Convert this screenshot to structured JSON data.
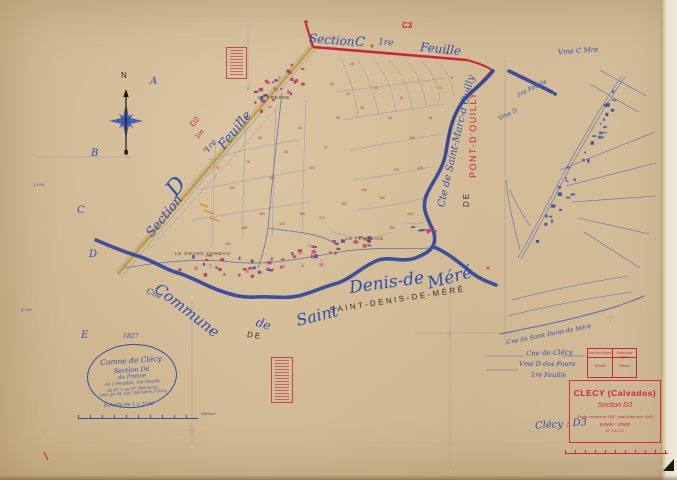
{
  "colors": {
    "paper": "#d5bc94",
    "ink_blue": "#2e4fae",
    "ink_red": "#c5283c",
    "ink_black": "#35302a",
    "boundary_blue": "#2b3f9d",
    "road_ochre": "#bb9733"
  },
  "compass": {
    "n": "N"
  },
  "grid_letters": [
    {
      "t": "A",
      "x": 150,
      "y": 76
    },
    {
      "t": "B",
      "x": 91,
      "y": 148
    },
    {
      "t": "C",
      "x": 77,
      "y": 205
    },
    {
      "t": "D",
      "x": 89,
      "y": 249
    },
    {
      "t": "E",
      "x": 81,
      "y": 330
    }
  ],
  "edge_notes": [
    {
      "t": "3.090",
      "x": 33,
      "y": 182
    },
    {
      "t": "4.581",
      "x": 21,
      "y": 307
    }
  ],
  "top_labels": {
    "section": "Section",
    "c": "C",
    "premiere": "1re",
    "feuille": "Feuille",
    "c3": "C3"
  },
  "west_labels": {
    "section": "Section",
    "d": "D",
    "premiere": "1re",
    "feuille": "Feuille",
    "d2": "D2",
    "d2_sheet": "1re"
  },
  "east_labels": {
    "saint_marc": "Cte de Saint-Marc-d'Ouilly",
    "pont": "PONT-D'OUILLY",
    "de": "DE",
    "vme_d": "Vme D",
    "feuille": "1re Feuille"
  },
  "south_labels": {
    "cne": "Cne",
    "commune": "Commune",
    "de_print": "DE",
    "de_script": "de",
    "saint": "Saint",
    "print": "SAINT-DENIS-DE-MÉRÉ",
    "denis": "Denis-de",
    "mere": "Méré"
  },
  "hamlets": [
    {
      "t": "LE FRESNE",
      "x": 258,
      "y": 95
    },
    {
      "t": "LE GRAND HAMEAU",
      "x": 175,
      "y": 251
    },
    {
      "t": "LE FLAGUAIS",
      "x": 346,
      "y": 236
    }
  ],
  "cartouche": {
    "year": "1827",
    "lines": [
      "Comne de Clécy",
      "Section De",
      "du Fresne",
      "en 2 Feuilles, 1re Feuille",
      "du N° 1 au N° 588 inclus",
      "Levé par M. Got, Géomètre à Clécy"
    ]
  },
  "scalebar": {
    "label": "Échelle de 1 à 2500",
    "unit": "Mètres"
  },
  "inset_labels": {
    "corner": "Vme C Mre",
    "curve": "Cne du Saint-Denis de Méré",
    "clecy": "Cne de Clécy",
    "fours": "Vme D des Fours",
    "feuille": "1re Feuille"
  },
  "ref_table": {
    "headers": [
      "Anciens types",
      "Nouveaux types"
    ],
    "values": [
      "Néant",
      "Néant"
    ]
  },
  "title_block": {
    "title": "CLECY (Calvados)",
    "section": "Section D3",
    "revision": "Feuille dressée en 1827, mise à jour pour 1936",
    "scale": "Échelle : 1/2500",
    "numbers": "N° 3 A 171"
  },
  "handwritten": {
    "ref": "Clécy : D3"
  },
  "parcel_numbers": [
    {
      "t": "84",
      "x": 205,
      "y": 150
    },
    {
      "t": "92",
      "x": 218,
      "y": 168
    },
    {
      "t": "105",
      "x": 232,
      "y": 188
    },
    {
      "t": "76",
      "x": 248,
      "y": 162
    },
    {
      "t": "58",
      "x": 260,
      "y": 138
    },
    {
      "t": "112",
      "x": 272,
      "y": 178
    },
    {
      "t": "63",
      "x": 286,
      "y": 152
    },
    {
      "t": "41",
      "x": 300,
      "y": 128
    },
    {
      "t": "118",
      "x": 312,
      "y": 168
    },
    {
      "t": "57",
      "x": 326,
      "y": 148
    },
    {
      "t": "36",
      "x": 338,
      "y": 118
    },
    {
      "t": "22",
      "x": 348,
      "y": 94
    },
    {
      "t": "28",
      "x": 362,
      "y": 108
    },
    {
      "t": "15",
      "x": 376,
      "y": 88
    },
    {
      "t": "44",
      "x": 390,
      "y": 118
    },
    {
      "t": "31",
      "x": 402,
      "y": 98
    },
    {
      "t": "126",
      "x": 412,
      "y": 138
    },
    {
      "t": "139",
      "x": 420,
      "y": 168
    },
    {
      "t": "131",
      "x": 396,
      "y": 170
    },
    {
      "t": "150",
      "x": 382,
      "y": 198
    },
    {
      "t": "146",
      "x": 364,
      "y": 190
    },
    {
      "t": "162",
      "x": 344,
      "y": 204
    },
    {
      "t": "171",
      "x": 322,
      "y": 218
    },
    {
      "t": "168",
      "x": 302,
      "y": 214
    },
    {
      "t": "176",
      "x": 282,
      "y": 224
    },
    {
      "t": "181",
      "x": 262,
      "y": 214
    },
    {
      "t": "188",
      "x": 244,
      "y": 228
    },
    {
      "t": "195",
      "x": 228,
      "y": 244
    },
    {
      "t": "48",
      "x": 430,
      "y": 118
    },
    {
      "t": "12",
      "x": 440,
      "y": 88
    },
    {
      "t": "8",
      "x": 452,
      "y": 78
    },
    {
      "t": "18",
      "x": 352,
      "y": 64
    },
    {
      "t": "26",
      "x": 332,
      "y": 84
    },
    {
      "t": "154",
      "x": 392,
      "y": 228
    },
    {
      "t": "143",
      "x": 410,
      "y": 214
    },
    {
      "t": "70",
      "x": 238,
      "y": 120
    }
  ]
}
